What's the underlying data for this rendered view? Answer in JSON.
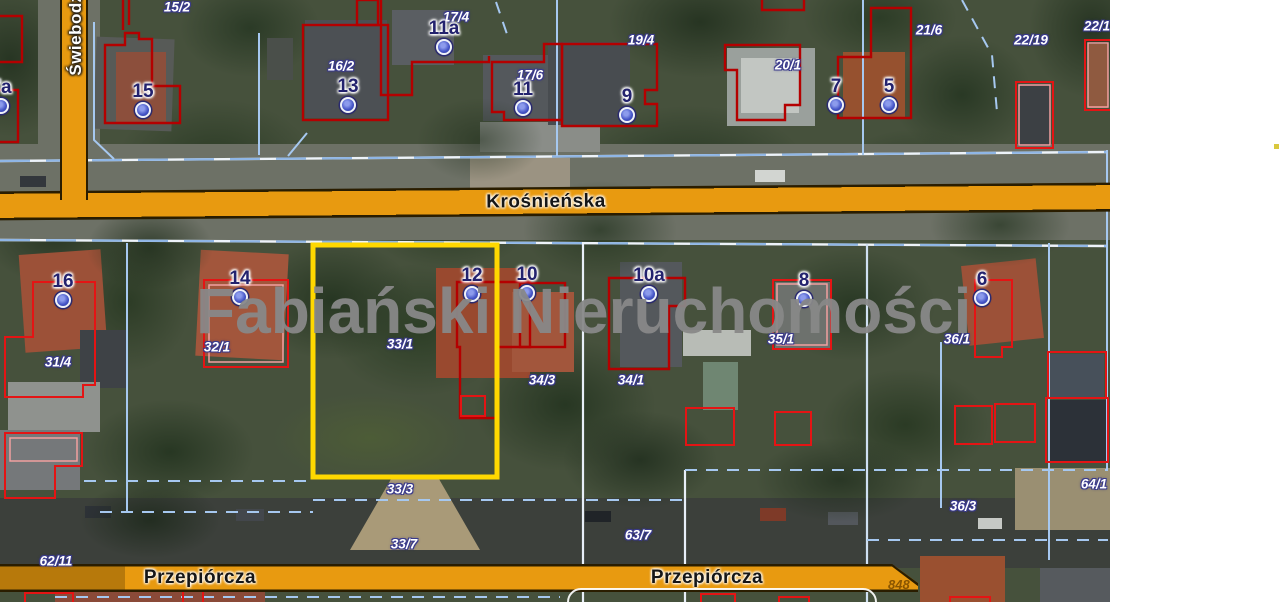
{
  "watermark": {
    "text": "Fabiański Nieruchomości"
  },
  "streets": {
    "horizontal_top": {
      "name": "Krośnieńska"
    },
    "bottom_left": {
      "name": "Przepiórcza"
    },
    "bottom_right": {
      "name": "Przepiórcza"
    },
    "vertical_left": {
      "name": "Świebodzi"
    },
    "corner_number": "848"
  },
  "colors": {
    "street_fill": "#E89A10",
    "street_border": "#2A1D00",
    "highlight_outline": "#FFD800",
    "parcel_red_dark": "#B40000",
    "parcel_red_bright": "#E41414",
    "boundary_blue": "#8FB6E6",
    "marker_dot_blue": "#4353C6",
    "marker_number_navy": "#23226E",
    "watermark_gray": "#888888"
  },
  "markers": [
    {
      "label": "7a",
      "x": 1,
      "y": 106
    },
    {
      "label": "15",
      "x": 143,
      "y": 110
    },
    {
      "label": "13",
      "x": 348,
      "y": 105
    },
    {
      "label": "11a",
      "x": 444,
      "y": 47
    },
    {
      "label": "11",
      "x": 523,
      "y": 108
    },
    {
      "label": "9",
      "x": 627,
      "y": 115
    },
    {
      "label": "7",
      "x": 836,
      "y": 105
    },
    {
      "label": "5",
      "x": 889,
      "y": 105
    },
    {
      "label": "16",
      "x": 63,
      "y": 300
    },
    {
      "label": "14",
      "x": 240,
      "y": 297
    },
    {
      "label": "12",
      "x": 472,
      "y": 294
    },
    {
      "label": "10",
      "x": 527,
      "y": 293
    },
    {
      "label": "10a",
      "x": 649,
      "y": 294
    },
    {
      "label": "8",
      "x": 804,
      "y": 299
    },
    {
      "label": "6",
      "x": 982,
      "y": 298
    }
  ],
  "parcel_labels": [
    {
      "text": "15/2",
      "x": 177,
      "y": 7
    },
    {
      "text": "17/4",
      "x": 456,
      "y": 17
    },
    {
      "text": "16/2",
      "x": 341,
      "y": 66
    },
    {
      "text": "17/6",
      "x": 530,
      "y": 75
    },
    {
      "text": "19/4",
      "x": 641,
      "y": 40
    },
    {
      "text": "20/1",
      "x": 788,
      "y": 65
    },
    {
      "text": "21/6",
      "x": 929,
      "y": 30
    },
    {
      "text": "22/19",
      "x": 1031,
      "y": 40
    },
    {
      "text": "22/1",
      "x": 1097,
      "y": 26
    },
    {
      "text": "31/4",
      "x": 58,
      "y": 362
    },
    {
      "text": "32/1",
      "x": 217,
      "y": 347
    },
    {
      "text": "33/1",
      "x": 400,
      "y": 344
    },
    {
      "text": "34/3",
      "x": 542,
      "y": 380
    },
    {
      "text": "34/1",
      "x": 631,
      "y": 380
    },
    {
      "text": "35/1",
      "x": 781,
      "y": 339
    },
    {
      "text": "36/1",
      "x": 957,
      "y": 339
    },
    {
      "text": "33/3",
      "x": 400,
      "y": 489
    },
    {
      "text": "33/7",
      "x": 404,
      "y": 544
    },
    {
      "text": "63/7",
      "x": 638,
      "y": 535
    },
    {
      "text": "36/3",
      "x": 963,
      "y": 506
    },
    {
      "text": "64/1",
      "x": 1094,
      "y": 484
    },
    {
      "text": "62/11",
      "x": 56,
      "y": 561
    }
  ]
}
